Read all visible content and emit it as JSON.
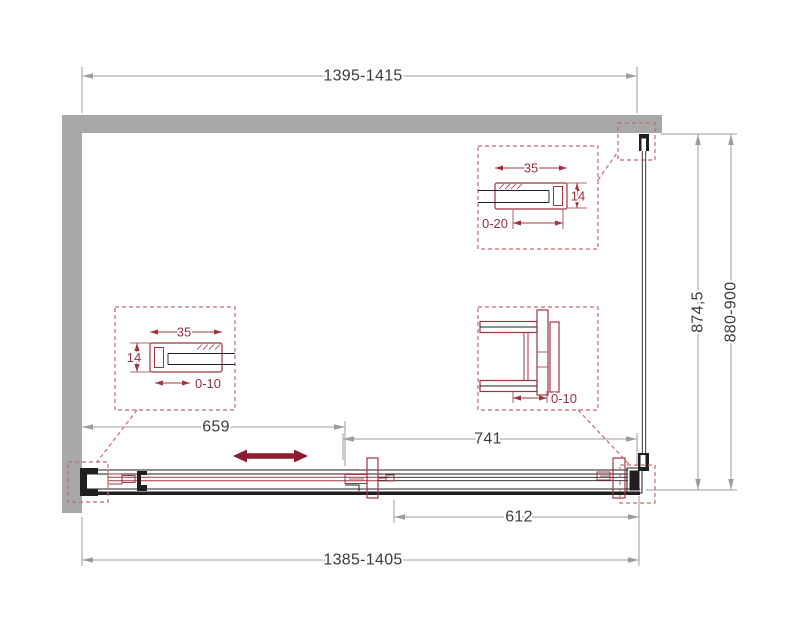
{
  "dims": {
    "top_width": "1395-1415",
    "bottom_width": "1385-1405",
    "door_width": "659",
    "fixed_width": "741",
    "glass_bottom_width": "612",
    "panel_height": "874,5",
    "height_range": "880-900"
  },
  "details": {
    "left_profile": {
      "width": "35",
      "depth": "14",
      "adjust": "0-10"
    },
    "top_profile": {
      "width": "35",
      "depth": "14",
      "adjust": "0-20"
    },
    "corner_bracket": {
      "adjust": "0-10"
    }
  },
  "colors": {
    "wall": "#a8a8a8",
    "outline": "#1f1f1f",
    "dimension_line": "#9c9c9c",
    "dimension_text": "#3b3b3b",
    "detail_red": "#a03540",
    "detail_dashed_red": "#c4686e",
    "detail_text_red": "#943140",
    "slide_arrow_red": "#8e1b2e"
  }
}
